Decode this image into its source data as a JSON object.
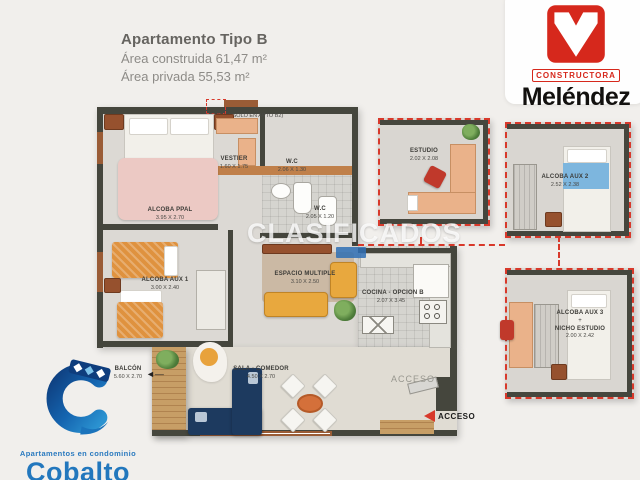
{
  "header": {
    "title": "Apartamento Tipo B",
    "area_construida": "Área construida 61,47 m²",
    "area_privada": "Área privada 55,53 m²"
  },
  "melendez": {
    "tag": "CONSTRUCTORA",
    "name": "Meléndez",
    "logo_color": "#d6281c"
  },
  "cobalto": {
    "tagline": "Apartamentos en condominio",
    "name": "Cobalto",
    "brand_color": "#2277bd"
  },
  "plan": {
    "ventana_note": "(VENTANA SOLO EN APTO B2)",
    "watermark": "CLASIFICADOS",
    "dashed_red": "#d8392b",
    "rooms": {
      "alcoba_ppal": {
        "label": "ALCOBA PPAL",
        "dim": "3.95 X 2.70"
      },
      "vestier": {
        "label": "VESTIER",
        "dim": "1.60 X 1.75"
      },
      "wc_1": {
        "label": "W.C",
        "dim": "2.06 X 1.30"
      },
      "wc_2": {
        "label": "W.C",
        "dim": "2.05 X 1.20"
      },
      "alcoba_aux_1": {
        "label": "ALCOBA AUX 1",
        "dim": "3.00 X 2.40"
      },
      "espacio_multiple": {
        "label": "ESPACIO MULTIPLE",
        "dim": "3.10 X 2.50"
      },
      "cocina": {
        "label": "COCINA - OPCION B",
        "dim": "2.07 X 3.45"
      },
      "sala_comedor": {
        "label": "SALA - COMEDOR",
        "dim": "4.50 X 2.70"
      },
      "balcon": {
        "label": "BALCÓN",
        "dim": "5.60 X 2.70"
      },
      "estudio": {
        "label": "ESTUDIO",
        "dim": "2.02 X 2.08"
      },
      "alcoba_aux_2": {
        "label": "ALCOBA AUX 2",
        "dim": "2.52 X 2.38"
      },
      "alcoba_aux_3": {
        "label": "ALCOBA AUX 3",
        "plus": "+",
        "label2": "NICHO ESTUDIO",
        "dim": "2.00 X 2.42"
      }
    },
    "acceso_door_label": "ACCESO",
    "acceso_arrow_label": "ACCESO"
  }
}
